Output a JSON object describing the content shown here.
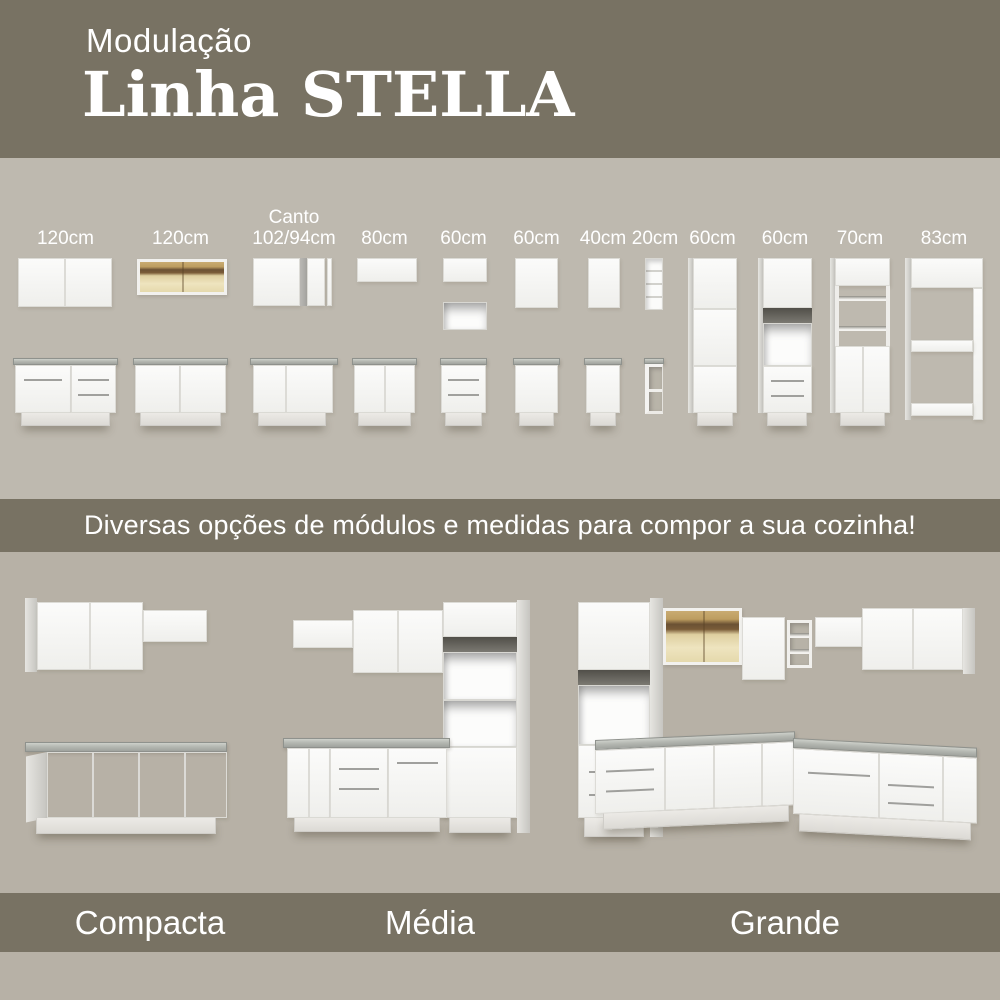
{
  "header": {
    "kicker": "Modulação",
    "title": "Linha STELLA"
  },
  "modules": {
    "items": [
      {
        "label": "120cm"
      },
      {
        "label": "120cm"
      },
      {
        "label": "Canto",
        "label2": "102/94cm"
      },
      {
        "label": "80cm"
      },
      {
        "label": "60cm"
      },
      {
        "label": "60cm"
      },
      {
        "label": "40cm"
      },
      {
        "label": "20cm"
      },
      {
        "label": "60cm"
      },
      {
        "label": "60cm"
      },
      {
        "label": "70cm"
      },
      {
        "label": "83cm"
      }
    ]
  },
  "banner": {
    "text": "Diversas opções de módulos e medidas para compor a sua cozinha!"
  },
  "kitchens": {
    "items": [
      {
        "label": "Compacta"
      },
      {
        "label": "Média"
      },
      {
        "label": "Grande"
      }
    ]
  },
  "colors": {
    "olive_band": "#787263",
    "background_top": "#beb9af",
    "background_bottom": "#b7b1a6",
    "text": "#ffffff",
    "cabinet_white": "#f5f5f3",
    "countertop_gray": "#a8aba5",
    "glass_amber": "#c9ab72"
  }
}
